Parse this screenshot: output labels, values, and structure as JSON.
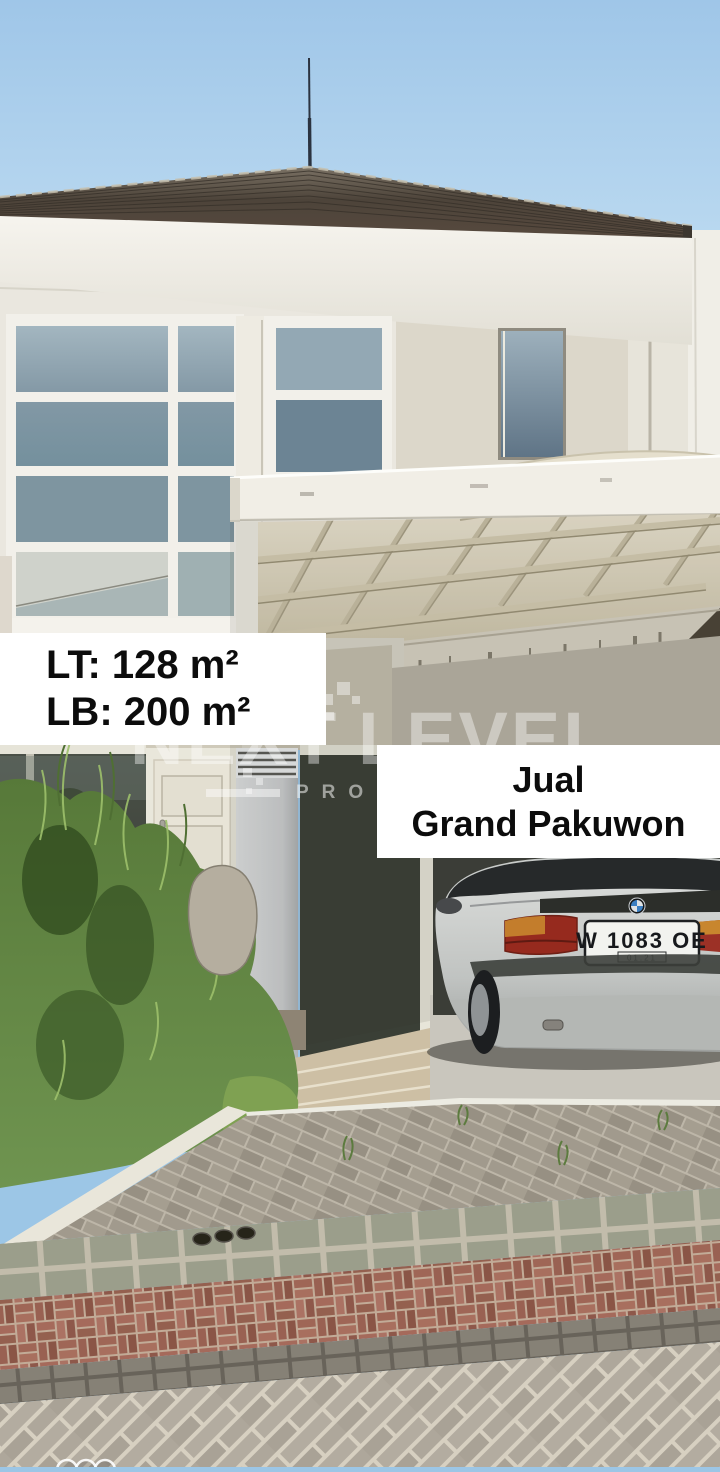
{
  "meta": {
    "type": "real-estate-listing-photo",
    "orientation": "portrait"
  },
  "overlay": {
    "area_box": {
      "land_area": "LT: 128 m²",
      "building_area": "LB: 200 m²"
    },
    "sale_box": {
      "line1": "Jual",
      "line2": "Grand Pakuwon"
    }
  },
  "watermark": {
    "word1": "NEXT",
    "word2": "LEVEL",
    "subtitle": "PROPERTY"
  },
  "car": {
    "license_plate": "W 1083 OE",
    "plate_expiry": "01.21",
    "make_logo": "bmw-roundel"
  },
  "scene": {
    "description": "Two-storey white minimalist house with arched carport canopy, silver BMW sedan parked, overgrown lawn with rock, tan walkway, grey/red paver street in foreground, blue sky above dark hip roof with antenna",
    "palette": {
      "sky": "#a5cbe9",
      "roof": "#55493e",
      "fascia": "#f1eee7",
      "upper_wall": "#eae7df",
      "accent_wall": "#dcd7ca",
      "window_glass": "#8298a5",
      "carport_beam": "#f1eee6",
      "canopy": "#e7e0cd",
      "dark_glass": "#3f443b",
      "door": "#e8e4d7",
      "column": "#d5d7d8",
      "grass": "#64894a",
      "grass_light": "#7fa152",
      "rock": "#b5ae9f",
      "walkway": "#cdbfa4",
      "curb": "#e9e6da",
      "paver_grey": "#aaa396",
      "paver_square": "#9b9e8b",
      "paver_red": "#9c6254",
      "paver_dark": "#868176",
      "street_paver": "#b2aba0",
      "car_body": "#c6c9c7",
      "taillight": "#a03024",
      "plate_bg": "#f2f3ef",
      "shadow": "#3f3e37"
    }
  }
}
